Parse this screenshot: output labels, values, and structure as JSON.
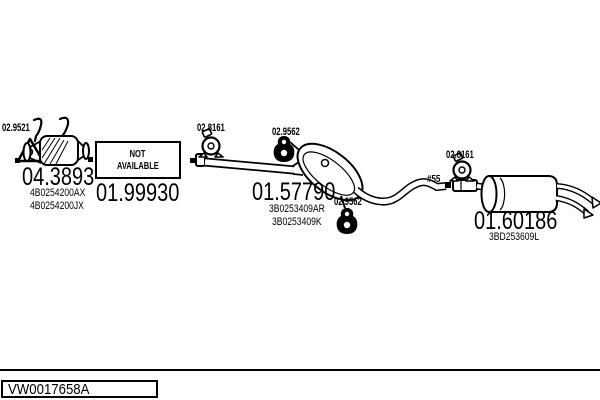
{
  "diagram_labels": {
    "hanger_front": "02.9521",
    "clamp_front": "02.8161",
    "hanger_mid": "02.9562",
    "hanger_rear_mid": "02.9562",
    "clamp_rear": "02.8161",
    "pipe_diameter_note": "#55"
  },
  "parts": {
    "catalyst": {
      "number": "04.3893",
      "oe_1": "4B0254200AX",
      "oe_2": "4B0254200JX"
    },
    "front_pipe": {
      "number": "01.99930",
      "availability_line1": "NOT",
      "availability_line2": "AVAILABLE"
    },
    "middle_muffler": {
      "number": "01.57790",
      "oe_1": "3B0253409AR",
      "oe_2": "3B0253409K"
    },
    "rear_muffler": {
      "number": "01.60186",
      "oe_1": "3BD253609L"
    }
  },
  "footer": {
    "drawing_code": "VW0017658A"
  }
}
